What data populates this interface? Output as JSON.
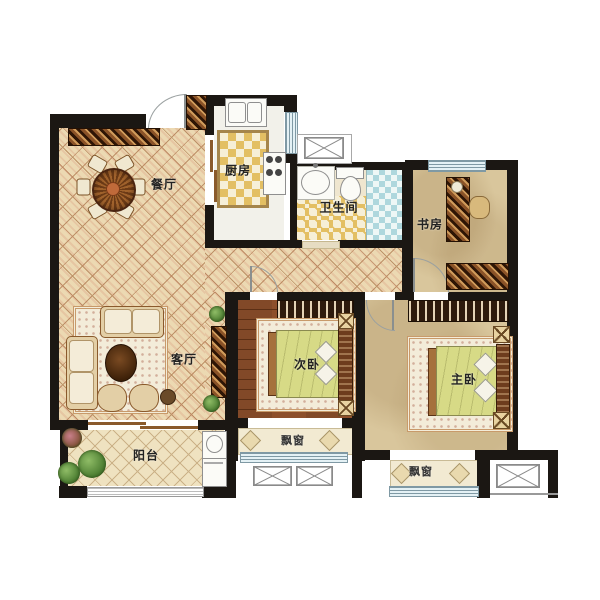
{
  "floorplan": {
    "title": "三室两厅户型图",
    "rooms": {
      "dining": {
        "label": "餐厅"
      },
      "kitchen": {
        "label": "厨房"
      },
      "bathroom": {
        "label": "卫生间"
      },
      "study": {
        "label": "书房"
      },
      "living": {
        "label": "客厅"
      },
      "bedroom2": {
        "label": "次卧"
      },
      "master": {
        "label": "主卧"
      },
      "balcony": {
        "label": "阳台"
      },
      "bay_window_bedroom2": {
        "label": "飘窗"
      },
      "bay_window_master": {
        "label": "飘窗"
      }
    },
    "palette": {
      "wall": "#1b1713",
      "parquet": "#ecd9b2",
      "kitchen_tile": "#e3bf63",
      "shower_tile": "#aed7dd",
      "bedroom_wood": "#8d4f2b",
      "blanket": "#d7da86",
      "window_blue": "#e4f1f5",
      "plan_background": "#ffffff"
    }
  }
}
